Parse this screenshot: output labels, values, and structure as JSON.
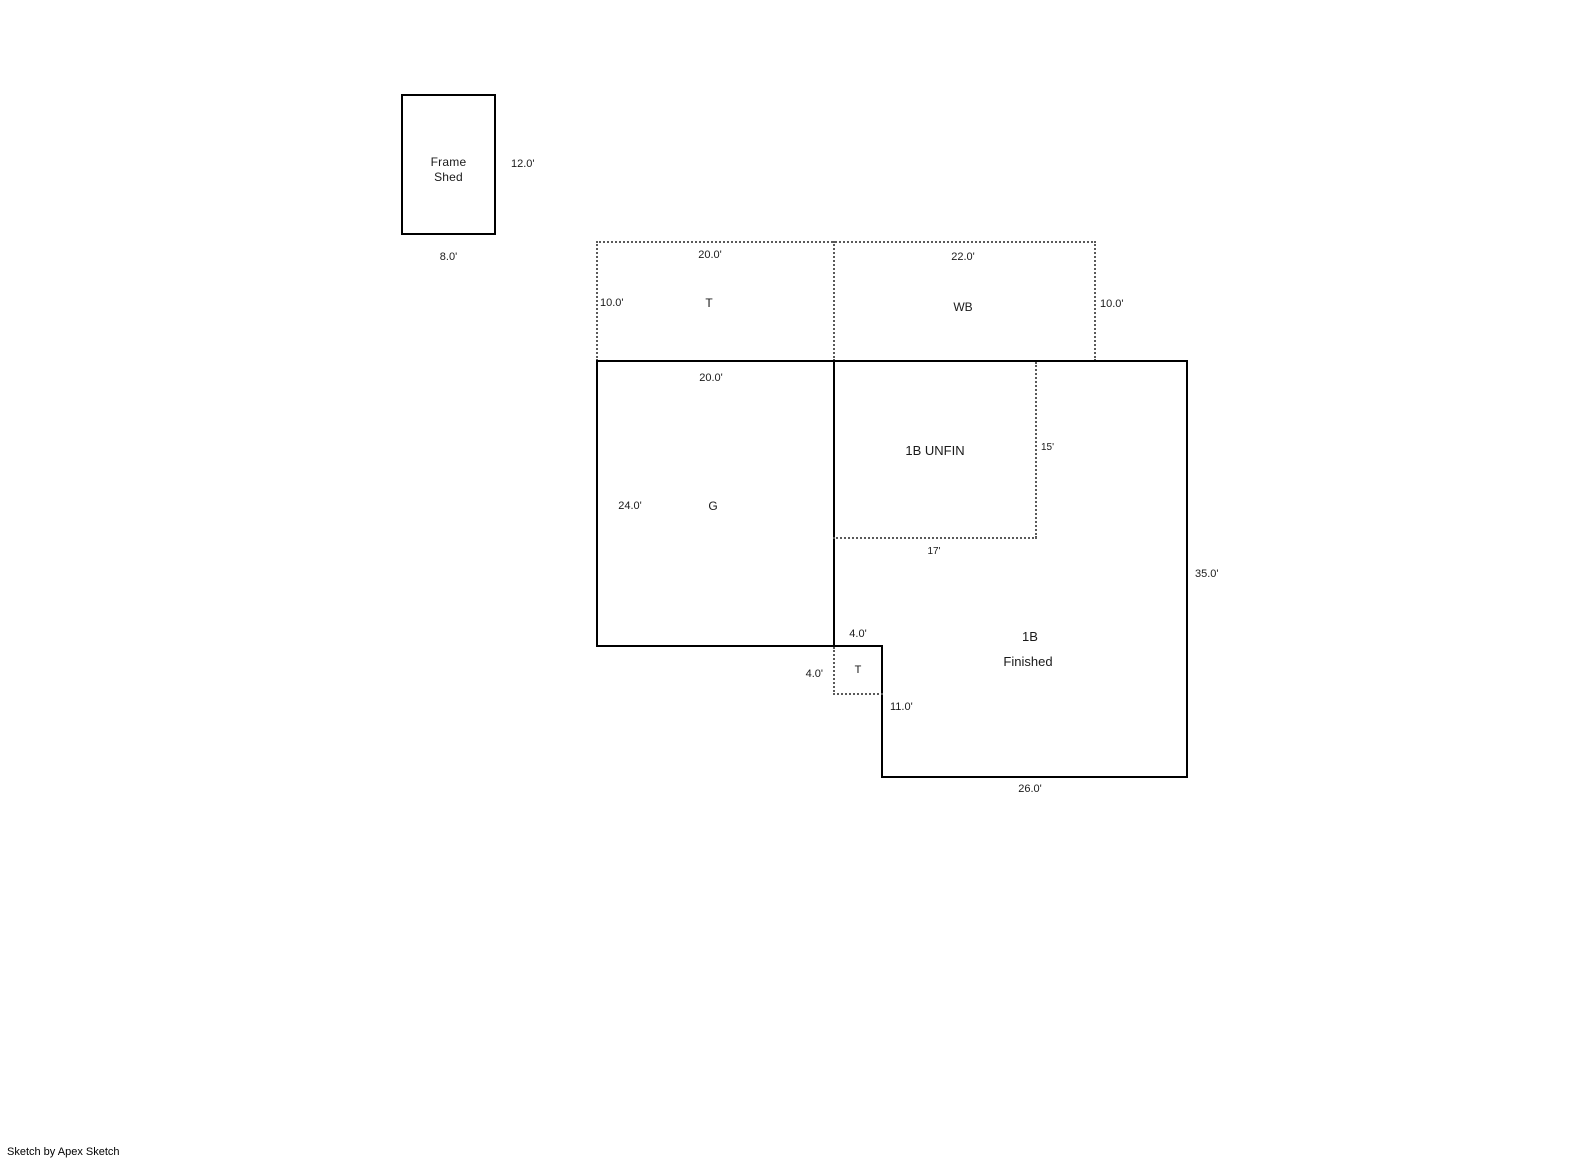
{
  "sketch": {
    "footer": "Sketch by Apex Sketch",
    "colors": {
      "wall": "#000000",
      "dotted_line": "#595959",
      "text": "#1a1a1a",
      "background": "#ffffff"
    },
    "shed": {
      "label_line1": "Frame",
      "label_line2": "Shed",
      "dim_right": "12.0'",
      "dim_bottom": "8.0'"
    },
    "porch_t": {
      "label": "T",
      "dim_top": "20.0'",
      "dim_left": "10.0'"
    },
    "porch_wb": {
      "label": "WB",
      "dim_top": "22.0'",
      "dim_right": "10.0'"
    },
    "garage": {
      "label": "G",
      "dim_top": "20.0'",
      "dim_left": "24.0'"
    },
    "basement_unfin": {
      "label": "1B UNFIN",
      "dim_right": "15'",
      "dim_bottom": "17'"
    },
    "porch_t_small": {
      "label": "T",
      "dim_top": "4.0'",
      "dim_left": "4.0'"
    },
    "basement_fin": {
      "label_line1": "1B",
      "label_line2": "Finished",
      "dim_right": "35.0'",
      "dim_step": "11.0'",
      "dim_bottom": "26.0'"
    }
  }
}
